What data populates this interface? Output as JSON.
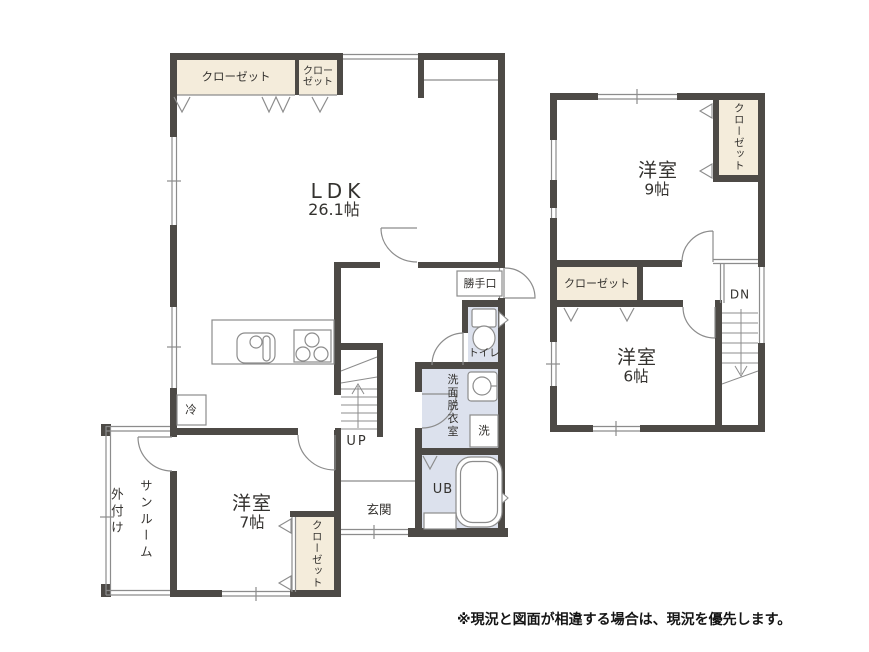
{
  "colors": {
    "wall": "#4d4a46",
    "closet_fill": "#f4ecdb",
    "wet_fill": "#dce1ed",
    "line": "#8c8c8c",
    "text": "#34322f"
  },
  "f1": {
    "ldk_name": "LDK",
    "ldk_size": "26.1帖",
    "closet_large": "クローゼット",
    "closet_small_1": "クロー",
    "closet_small_2": "ゼット",
    "back_door": "勝手口",
    "toilet": "トイレ",
    "washroom": "洗面脱衣室",
    "washer": "洗",
    "up": "UP",
    "bath": "UB",
    "entrance": "玄関",
    "fridge": "冷",
    "room7_name": "洋室",
    "room7_size": "7帖",
    "room7_closet": "クローゼット",
    "sunroom_1": "外付け",
    "sunroom_2": "サンルーム"
  },
  "f2": {
    "room9_name": "洋室",
    "room9_size": "9帖",
    "room9_closet": "クローゼット",
    "hall_closet": "クローゼット",
    "dn": "DN",
    "room6_name": "洋室",
    "room6_size": "6帖"
  },
  "footer": {
    "disclaimer": "※現況と図面が相違する場合は、現況を優先します。"
  }
}
